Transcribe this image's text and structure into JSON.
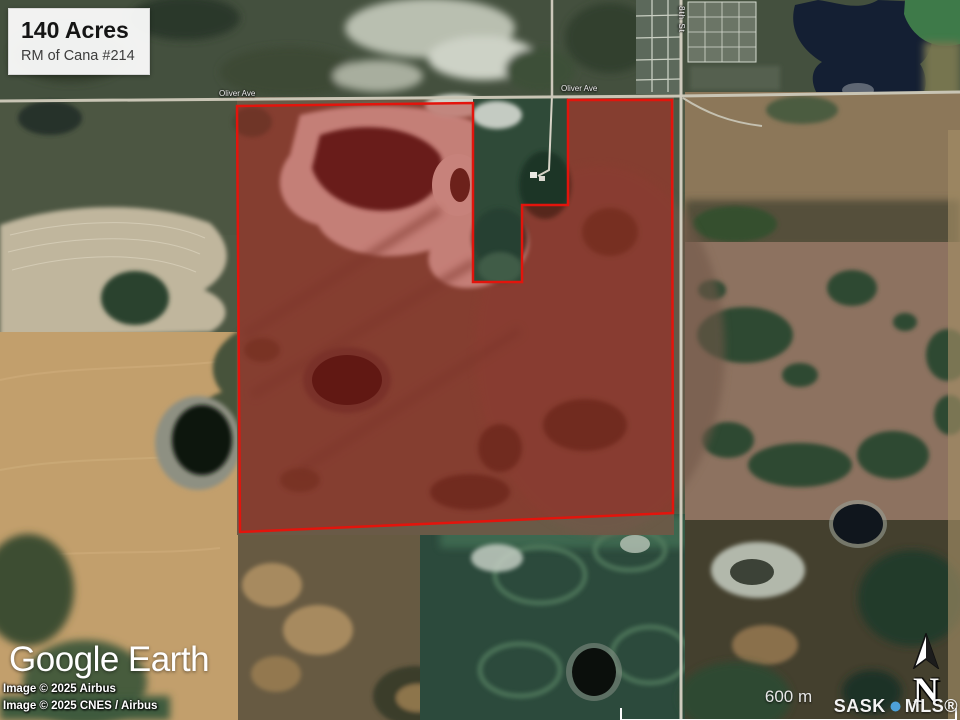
{
  "info_box": {
    "acreage": "140 Acres",
    "municipality": "RM of Cana #214"
  },
  "road_labels": {
    "oliver_ave_west": "Oliver Ave",
    "oliver_ave_east": "Oliver Ave",
    "eighth_st": "8th St"
  },
  "branding": {
    "google": "Google",
    "earth": "Earth"
  },
  "attribution": {
    "line1": "Image © 2025 Airbus",
    "line2": "Image © 2025 CNES / Airbus"
  },
  "scale_bar": {
    "label": "600 m"
  },
  "compass": {
    "label": "N",
    "icon": "north-arrow"
  },
  "watermark": {
    "sask": "SASK",
    "mls": "MLS®"
  },
  "colors": {
    "boundary_stroke": "#e3140c",
    "boundary_fill": "#b01510",
    "boundary_fill_opacity": "0.40",
    "mls_dot": "#4da0d8"
  }
}
